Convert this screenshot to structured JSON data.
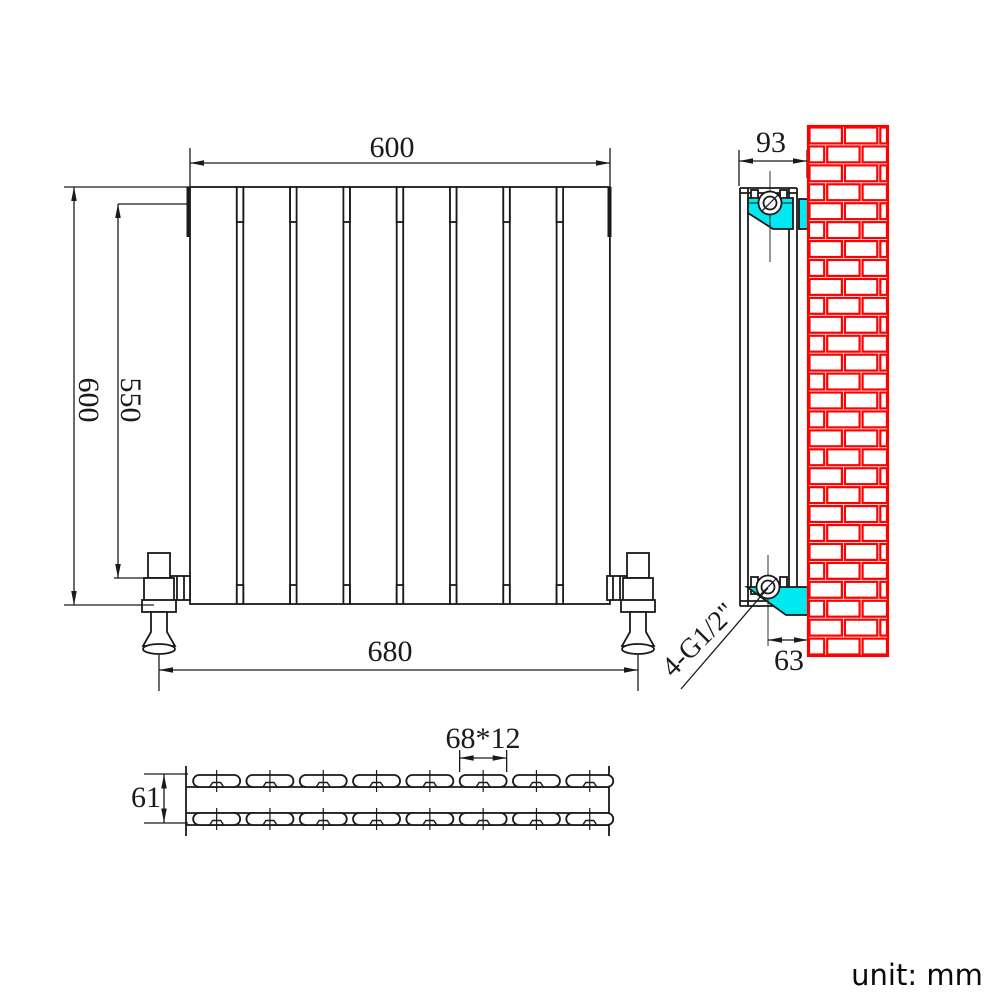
{
  "drawing": {
    "unit_note": "unit: mm",
    "colors": {
      "line": "#1a1a1a",
      "bracket": "#00e8f0",
      "brick": "#ff0000"
    },
    "front_view": {
      "panel_count": 8,
      "dim_width": "600",
      "dim_height": "600",
      "dim_height_inner": "550",
      "dim_valve_span": "680"
    },
    "side_view": {
      "dim_depth": "93",
      "dim_bracket_depth": "63",
      "connection_label": "4-G1/2\""
    },
    "top_view": {
      "slots_per_row": 8,
      "dim_slot_size": "68*12",
      "dim_depth": "61"
    }
  }
}
